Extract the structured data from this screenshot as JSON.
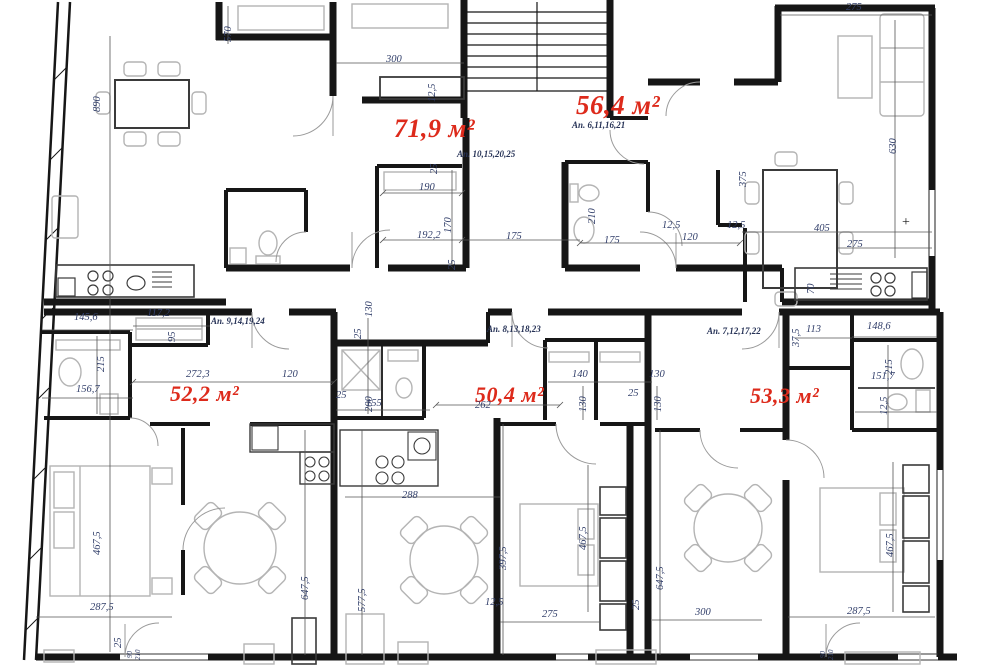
{
  "drawing": {
    "kind": "apartment-building-floor-plan",
    "colors": {
      "wall": "#161616",
      "furniture": "#b4b4b4",
      "dimension_text": "#33406b",
      "area_label": "#dd2a1b"
    },
    "apartments": [
      {
        "area": "71,9 м²",
        "units": "Ап. 10,15,20,25"
      },
      {
        "area": "56,4 м²",
        "units": "Ап. 6,11,16,21"
      },
      {
        "area": "52,2 м²",
        "units": "Ап. 9,14,19,24"
      },
      {
        "area": "50,4 м²",
        "units": "Ап. 8,13,18,23"
      },
      {
        "area": "53,3 м²",
        "units": "Ап. 7,12,17,22"
      }
    ],
    "texts": [
      {
        "t": "71,9 м²",
        "x": 394,
        "y": 116,
        "c": "area",
        "s": 26
      },
      {
        "t": "56,4 м²",
        "x": 576,
        "y": 92,
        "c": "area",
        "s": 27
      },
      {
        "t": "52,2 м²",
        "x": 170,
        "y": 383,
        "c": "area"
      },
      {
        "t": "50,4 м²",
        "x": 475,
        "y": 384,
        "c": "area"
      },
      {
        "t": "53,3 м²",
        "x": 750,
        "y": 385,
        "c": "area"
      },
      {
        "t": "Ап. 10,15,20,25",
        "x": 457,
        "y": 150,
        "c": "apt"
      },
      {
        "t": "Ап. 6,11,16,21",
        "x": 572,
        "y": 121,
        "c": "apt"
      },
      {
        "t": "Ап. 9,14,19,24",
        "x": 211,
        "y": 317,
        "c": "apt"
      },
      {
        "t": "Ап. 8,13,18,23",
        "x": 487,
        "y": 325,
        "c": "apt"
      },
      {
        "t": "Ап. 7,12,17,22",
        "x": 707,
        "y": 327,
        "c": "apt"
      },
      {
        "t": "300",
        "x": 386,
        "y": 55,
        "c": "dim"
      },
      {
        "t": "190",
        "x": 419,
        "y": 183,
        "c": "dim"
      },
      {
        "t": "192,2",
        "x": 417,
        "y": 231,
        "c": "dim"
      },
      {
        "t": "175",
        "x": 506,
        "y": 232,
        "c": "dim"
      },
      {
        "t": "175",
        "x": 604,
        "y": 236,
        "c": "dim"
      },
      {
        "t": "12,5",
        "x": 662,
        "y": 221,
        "c": "dim"
      },
      {
        "t": "120",
        "x": 682,
        "y": 233,
        "c": "dim"
      },
      {
        "t": "12,5",
        "x": 727,
        "y": 221,
        "c": "dim"
      },
      {
        "t": "405",
        "x": 814,
        "y": 224,
        "c": "dim"
      },
      {
        "t": "275",
        "x": 847,
        "y": 240,
        "c": "dim"
      },
      {
        "t": "275",
        "x": 846,
        "y": 3,
        "c": "dim"
      },
      {
        "t": "145,6",
        "x": 74,
        "y": 313,
        "c": "dim"
      },
      {
        "t": "117,2",
        "x": 147,
        "y": 309,
        "c": "dim"
      },
      {
        "t": "156,7",
        "x": 76,
        "y": 385,
        "c": "dim"
      },
      {
        "t": "272,3",
        "x": 186,
        "y": 370,
        "c": "dim"
      },
      {
        "t": "120",
        "x": 282,
        "y": 370,
        "c": "dim"
      },
      {
        "t": "25",
        "x": 336,
        "y": 391,
        "c": "dim"
      },
      {
        "t": "155",
        "x": 366,
        "y": 399,
        "c": "dim"
      },
      {
        "t": "262",
        "x": 475,
        "y": 401,
        "c": "dim"
      },
      {
        "t": "140",
        "x": 572,
        "y": 370,
        "c": "dim"
      },
      {
        "t": "25",
        "x": 628,
        "y": 389,
        "c": "dim"
      },
      {
        "t": "130",
        "x": 649,
        "y": 370,
        "c": "dim"
      },
      {
        "t": "113",
        "x": 806,
        "y": 325,
        "c": "dim"
      },
      {
        "t": "148,6",
        "x": 867,
        "y": 322,
        "c": "dim"
      },
      {
        "t": "151,7",
        "x": 871,
        "y": 372,
        "c": "dim"
      },
      {
        "t": "287,5",
        "x": 90,
        "y": 603,
        "c": "dim"
      },
      {
        "t": "275",
        "x": 542,
        "y": 610,
        "c": "dim"
      },
      {
        "t": "300",
        "x": 695,
        "y": 608,
        "c": "dim"
      },
      {
        "t": "287,5",
        "x": 847,
        "y": 607,
        "c": "dim"
      },
      {
        "t": "288",
        "x": 402,
        "y": 491,
        "c": "dim"
      },
      {
        "t": "12,5",
        "x": 485,
        "y": 598,
        "c": "dim"
      },
      {
        "t": "+",
        "x": 902,
        "y": 216,
        "c": "plus"
      },
      {
        "t": "890",
        "x": 93,
        "y": 112,
        "c": "dim-v"
      },
      {
        "t": "570",
        "x": 224,
        "y": 42,
        "c": "dim-v"
      },
      {
        "t": "12,5",
        "x": 428,
        "y": 102,
        "c": "dim-v"
      },
      {
        "t": "25",
        "x": 430,
        "y": 174,
        "c": "dim-v"
      },
      {
        "t": "170",
        "x": 444,
        "y": 233,
        "c": "dim-v"
      },
      {
        "t": "25",
        "x": 448,
        "y": 270,
        "c": "dim-v"
      },
      {
        "t": "210",
        "x": 588,
        "y": 224,
        "c": "dim-v"
      },
      {
        "t": "375",
        "x": 739,
        "y": 187,
        "c": "dim-v"
      },
      {
        "t": "630",
        "x": 889,
        "y": 154,
        "c": "dim-v"
      },
      {
        "t": "70",
        "x": 807,
        "y": 294,
        "c": "dim-v"
      },
      {
        "t": "95",
        "x": 168,
        "y": 342,
        "c": "dim-v"
      },
      {
        "t": "215",
        "x": 97,
        "y": 372,
        "c": "dim-v"
      },
      {
        "t": "130",
        "x": 365,
        "y": 317,
        "c": "dim-v"
      },
      {
        "t": "25",
        "x": 354,
        "y": 339,
        "c": "dim-v"
      },
      {
        "t": "200",
        "x": 365,
        "y": 412,
        "c": "dim-v"
      },
      {
        "t": "130",
        "x": 579,
        "y": 412,
        "c": "dim-v"
      },
      {
        "t": "130",
        "x": 654,
        "y": 412,
        "c": "dim-v"
      },
      {
        "t": "37,5",
        "x": 792,
        "y": 347,
        "c": "dim-v"
      },
      {
        "t": "215",
        "x": 885,
        "y": 375,
        "c": "dim-v"
      },
      {
        "t": "12,5",
        "x": 880,
        "y": 415,
        "c": "dim-v"
      },
      {
        "t": "467,5",
        "x": 93,
        "y": 555,
        "c": "dim-v"
      },
      {
        "t": "467,5",
        "x": 579,
        "y": 550,
        "c": "dim-v"
      },
      {
        "t": "467,5",
        "x": 886,
        "y": 557,
        "c": "dim-v"
      },
      {
        "t": "647,5",
        "x": 301,
        "y": 600,
        "c": "dim-v"
      },
      {
        "t": "577,5",
        "x": 358,
        "y": 612,
        "c": "dim-v"
      },
      {
        "t": "647,5",
        "x": 656,
        "y": 590,
        "c": "dim-v"
      },
      {
        "t": "397,5",
        "x": 499,
        "y": 570,
        "c": "dim-v"
      },
      {
        "t": "25",
        "x": 632,
        "y": 610,
        "c": "dim-v"
      },
      {
        "t": "25",
        "x": 114,
        "y": 648,
        "c": "dim-v"
      },
      {
        "t": "90",
        "x": 127,
        "y": 658,
        "c": "dv"
      },
      {
        "t": "210",
        "x": 135,
        "y": 660,
        "c": "dv"
      },
      {
        "t": "90",
        "x": 820,
        "y": 658,
        "c": "dv"
      },
      {
        "t": "210",
        "x": 828,
        "y": 660,
        "c": "dv"
      }
    ]
  }
}
